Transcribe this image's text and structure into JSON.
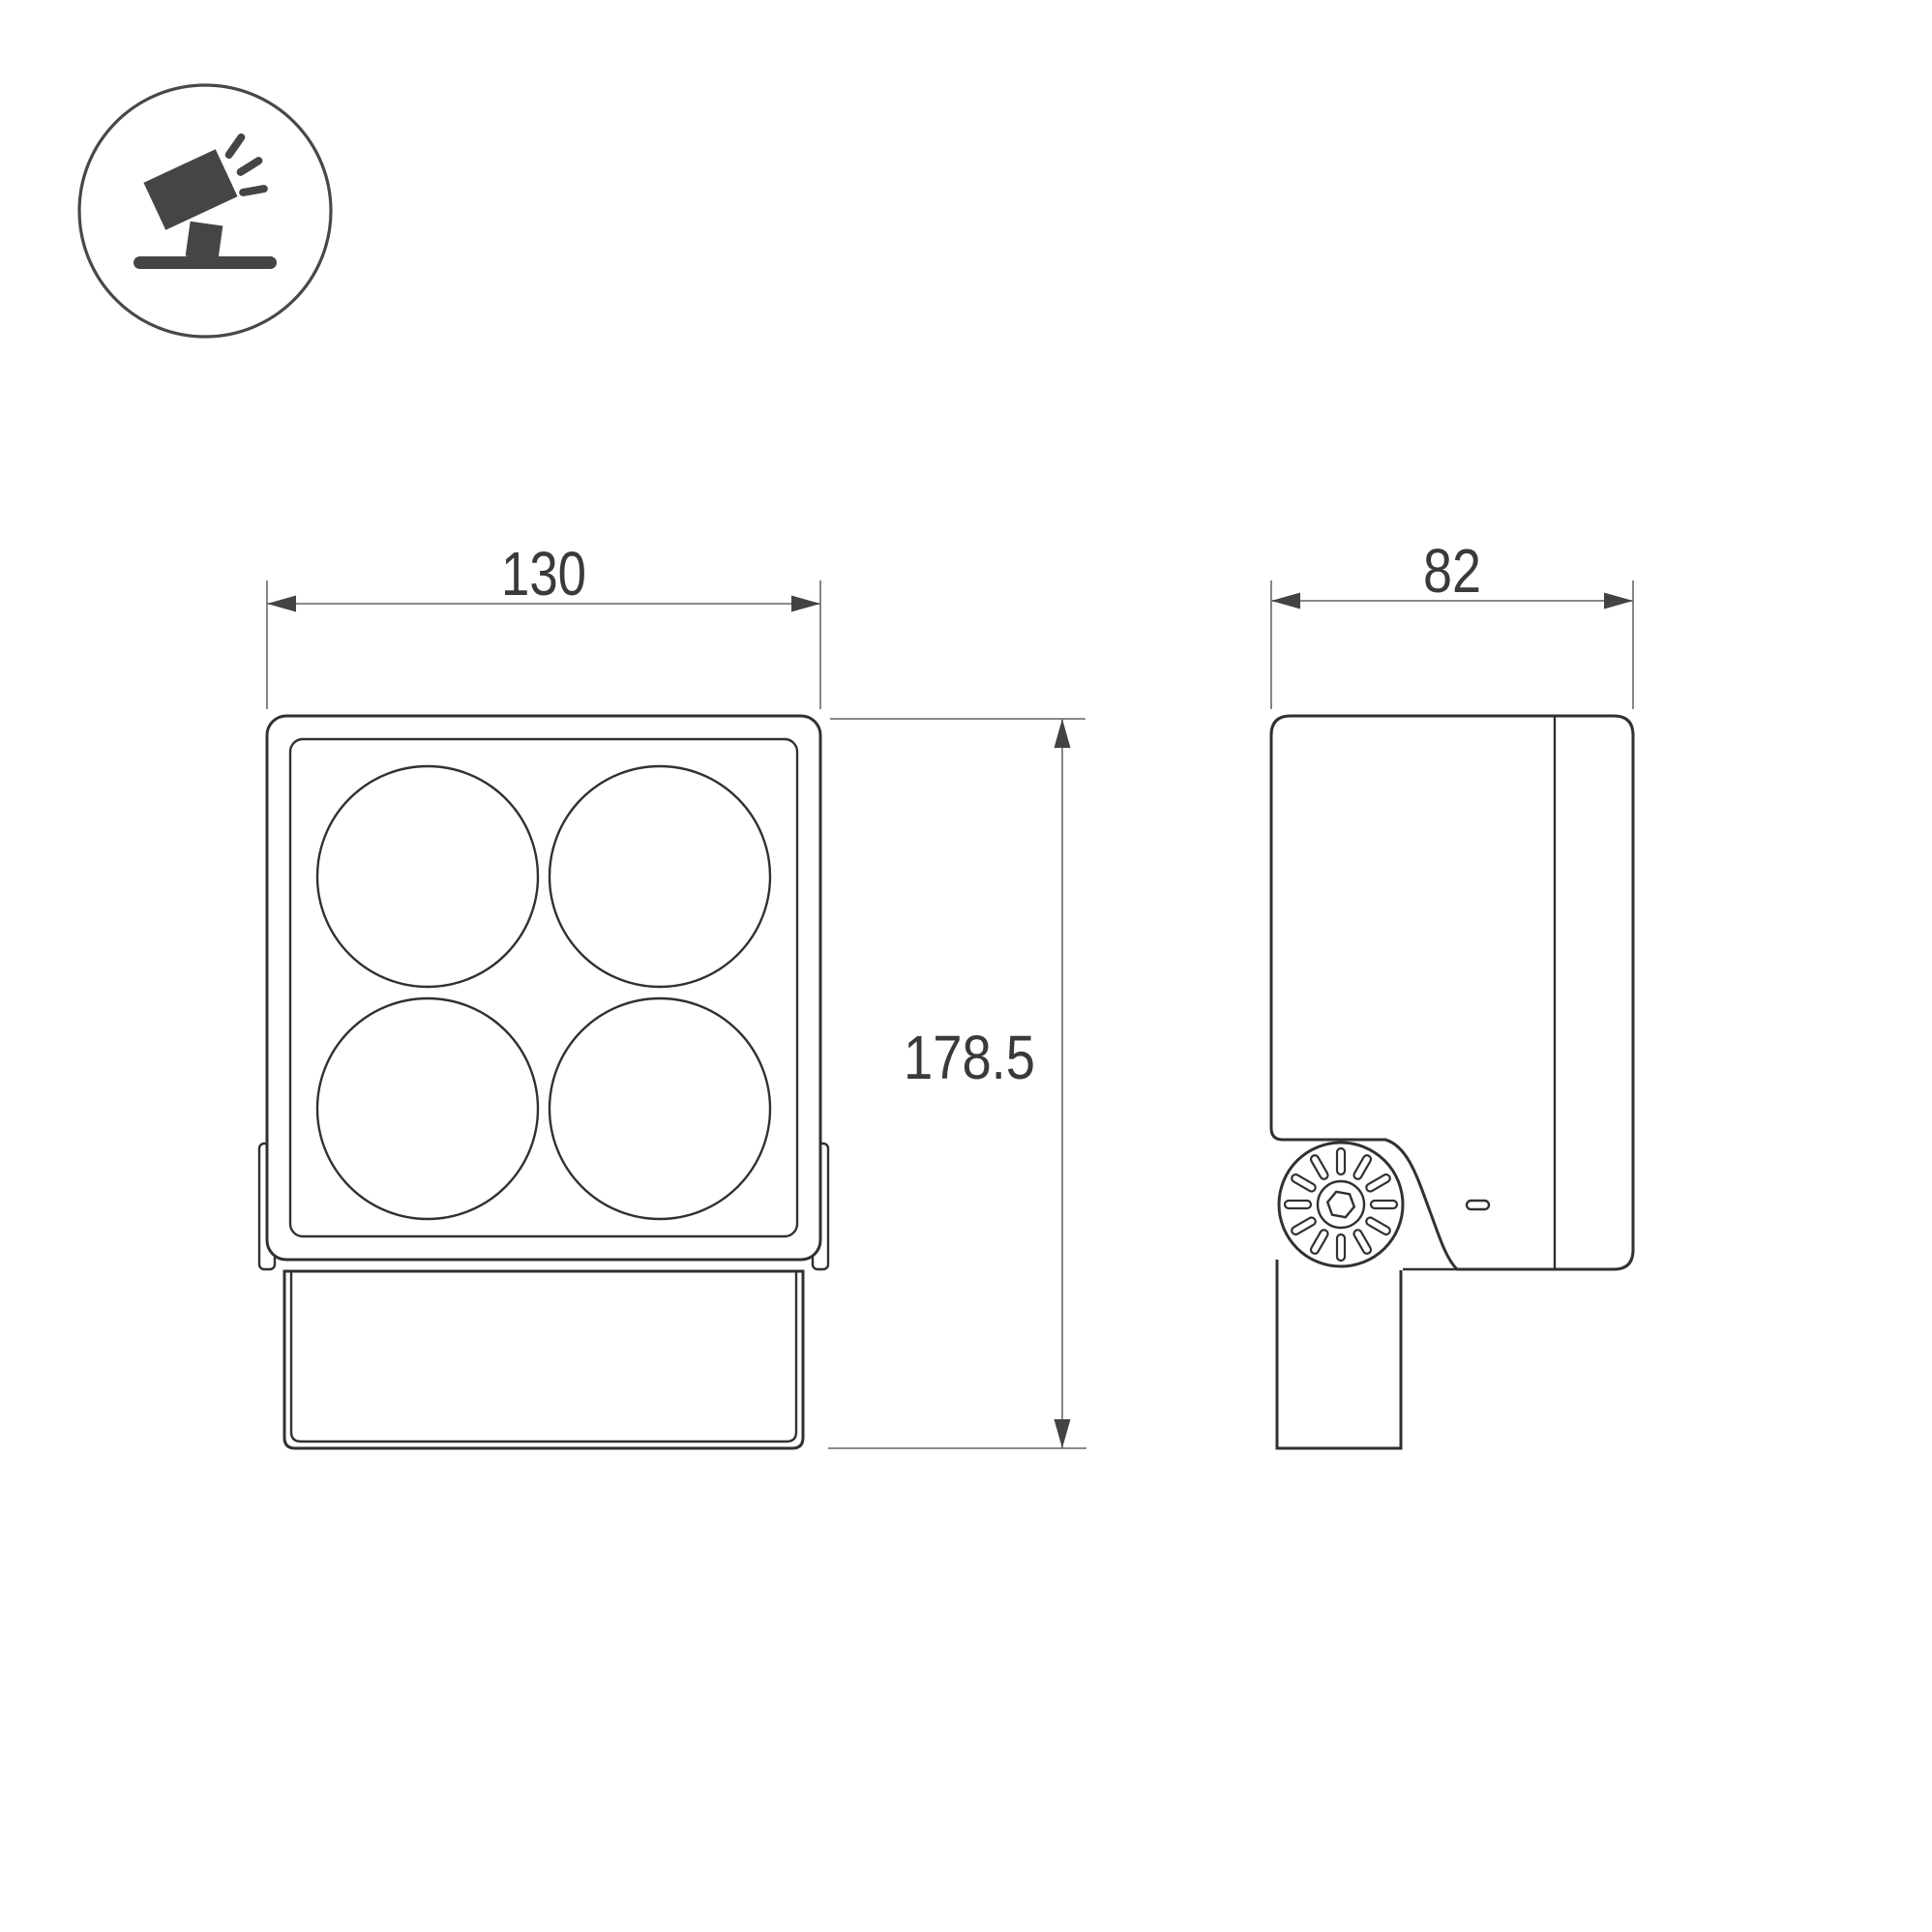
{
  "drawing": {
    "type": "technical-dimension-drawing",
    "subject": "LED floodlight with square 4-lens head and mounting bracket",
    "views": [
      "front",
      "side"
    ],
    "dims": {
      "width": "130",
      "depth": "82",
      "height": "178.5"
    },
    "icon": {
      "name": "tilted-floodlight-on-stand-icon",
      "style": "solid pictogram in outlined circle"
    },
    "features": {
      "front_lenses": 4,
      "knob_slots": 12,
      "knob_socket": "hex"
    },
    "colors": {
      "background": "#ffffff",
      "outline": "#313133",
      "dimension_line": "#77797b",
      "arrow": "#434345",
      "text": "#3a3a3c",
      "icon_fill": "#454547"
    }
  }
}
